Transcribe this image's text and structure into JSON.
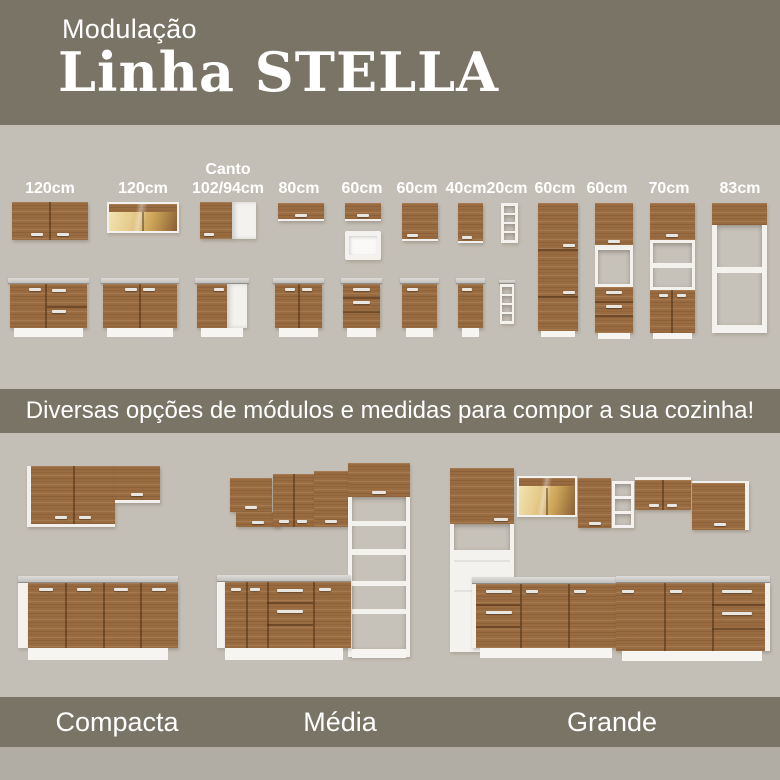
{
  "colors": {
    "band": "#7a7466",
    "bg": "#c4bfb6",
    "bg2": "#b2ada4",
    "wood": "#996b41"
  },
  "header": {
    "kicker": "Modulação",
    "title": "Linha STELLA"
  },
  "modules": {
    "columns": [
      {
        "line1": "",
        "line2": "120cm"
      },
      {
        "line1": "",
        "line2": "120cm"
      },
      {
        "line1": "Canto",
        "line2": "102/94cm"
      },
      {
        "line1": "",
        "line2": "80cm"
      },
      {
        "line1": "",
        "line2": "60cm"
      },
      {
        "line1": "",
        "line2": "60cm"
      },
      {
        "line1": "",
        "line2": "40cm"
      },
      {
        "line1": "",
        "line2": "20cm"
      },
      {
        "line1": "",
        "line2": "60cm"
      },
      {
        "line1": "",
        "line2": "60cm"
      },
      {
        "line1": "",
        "line2": "70cm"
      },
      {
        "line1": "",
        "line2": "83cm"
      }
    ]
  },
  "banner": {
    "text": "Diversas opções de módulos e medidas para compor a sua cozinha!"
  },
  "kitchens": {
    "items": [
      {
        "name": "Compacta"
      },
      {
        "name": "Média"
      },
      {
        "name": "Grande"
      }
    ]
  }
}
